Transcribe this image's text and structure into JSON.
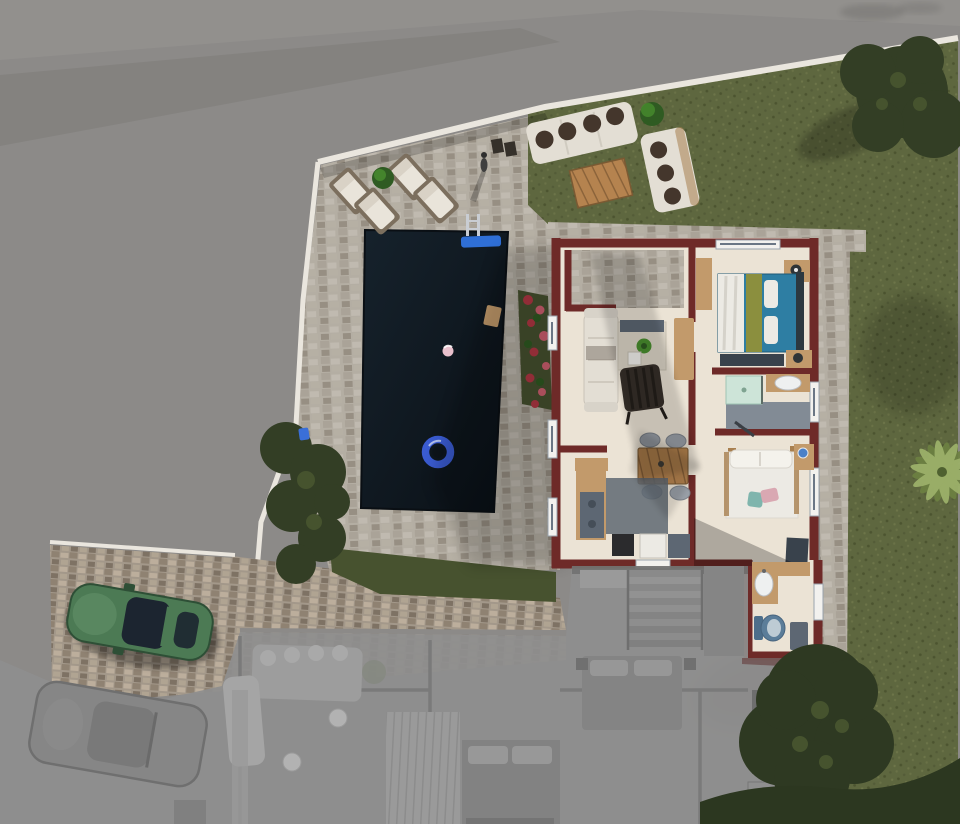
{
  "scene": {
    "type": "architectural-top-down-render",
    "entities": [
      "swimming-pool",
      "pool-ring-float",
      "pool-ladder",
      "pool-mat",
      "pool-ball",
      "stone-patio",
      "lounge-chairs",
      "garden-sofa-set",
      "wooden-coffee-table",
      "lawn",
      "trees",
      "palm-tree",
      "flower-bed",
      "hedge",
      "house",
      "entry-terrace",
      "living-room",
      "dining-area",
      "kitchen",
      "bedroom-teal",
      "bathroom",
      "bedroom-white",
      "annex-bathroom",
      "green-car",
      "driveway",
      "ghost-lower-floor",
      "ghost-car",
      "ghost-staircase",
      "perimeter-wall",
      "road"
    ]
  },
  "colors": {
    "bg_gray": "#8c8a88",
    "road_dark": "#7e7c79",
    "road_light": "#9a9896",
    "curb": "#eae6de",
    "stone": "#b4aea3",
    "stone_dark": "#9b9488",
    "drive": "#a3988a",
    "grass": "#5e673f",
    "grass_dark": "#47522f",
    "hedge": "#2c3720",
    "tree": "#333e25",
    "tree_light": "#46532e",
    "palm": "#9cb06a",
    "palm_dark": "#6d8142",
    "pool_a": "#16222c",
    "pool_b": "#0a1016",
    "float_blue": "#3a5bd0",
    "mat_blue": "#2f6fd6",
    "ladder": "#c9cdd3",
    "maroon": "#6e2a28",
    "maroon_dark": "#571f1e",
    "floor": "#ebe3d5",
    "wood": "#c29a6b",
    "wood_dark": "#a87f4f",
    "plank": "#b5834f",
    "teal": "#2e7ea3",
    "olive": "#8b8f3e",
    "navy": "#2c3840",
    "white_soft": "#eceae4",
    "sofa": "#e3ded4",
    "pillow_dark": "#44362c",
    "gray_blue": "#5d6773",
    "slate": "#39424c",
    "mint": "#cde4d8",
    "pink": "#d9a8b2",
    "teal_cushion": "#7fb5ad",
    "flower_red": "#b23844",
    "flower_red2": "#d06070",
    "ghost": "#8e8e8e",
    "ghost_light": "#a7a7a7",
    "ghost_mid": "#979797",
    "ghost_dark": "#777777",
    "ghost_line": "#6f6f6f",
    "car_green": "#4c7a54",
    "car_green_dark": "#2e4f36",
    "glass": "#1c2530",
    "sink": "#eef0f0",
    "toilet_blue": "#5b7d99",
    "water_blue": "#4a80c8",
    "plant_green": "#4a8f2f",
    "plant_dark": "#2f5b22",
    "ball_pink": "#e8c0cc",
    "white": "#f2f1ee"
  }
}
